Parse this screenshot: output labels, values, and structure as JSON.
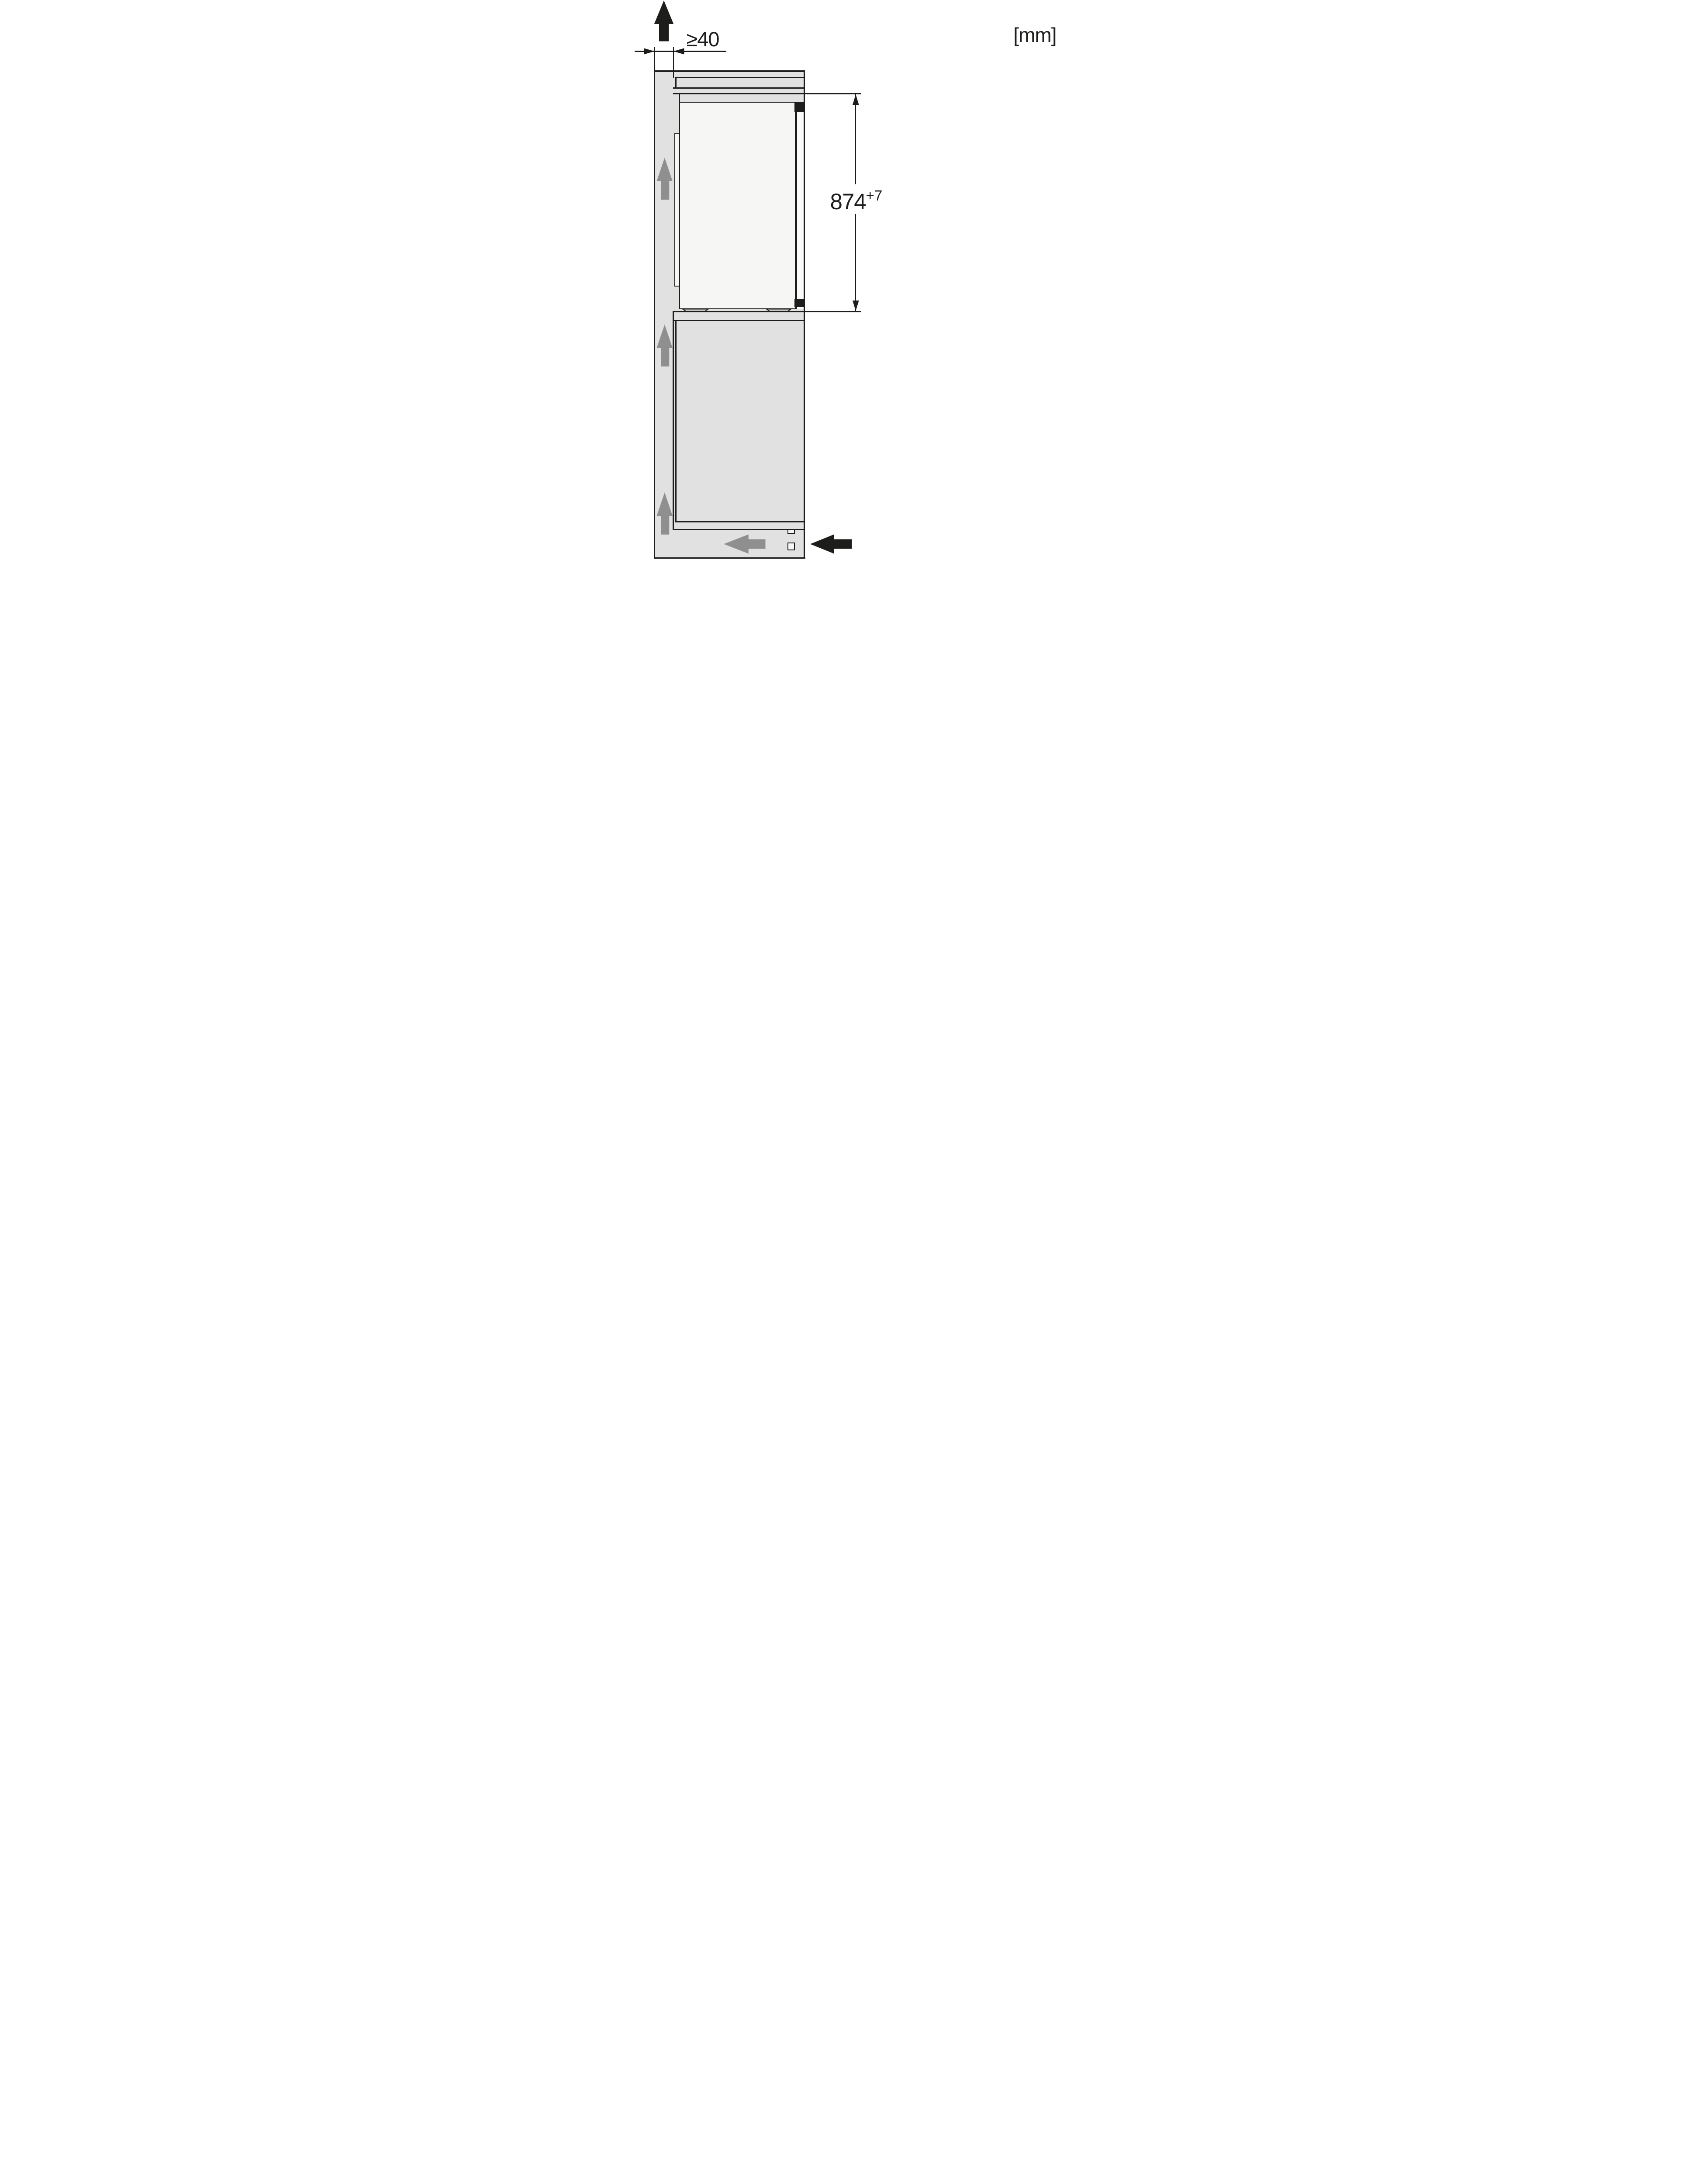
{
  "diagram": {
    "name": "built-in-refrigerator-niche-ventilation-side-view",
    "unit_label": "[mm]",
    "dimensions": {
      "top_clearance": {
        "label": "≥40"
      },
      "niche_height": {
        "value": "874",
        "tolerance": "+7"
      }
    },
    "colors": {
      "line": "#1d1d1b",
      "panel_gray": "#e1e1e1",
      "door_white": "#f6f6f5",
      "gap_white": "#fafafa",
      "airflow_gray": "#8f8f8f",
      "background": "#ffffff"
    },
    "icons": [
      "exhaust-air-up-arrow-icon",
      "airflow-up-arrow-icon",
      "airflow-left-arrow-icon",
      "air-inlet-left-arrow-icon",
      "dimension-arrowhead-icon"
    ]
  }
}
